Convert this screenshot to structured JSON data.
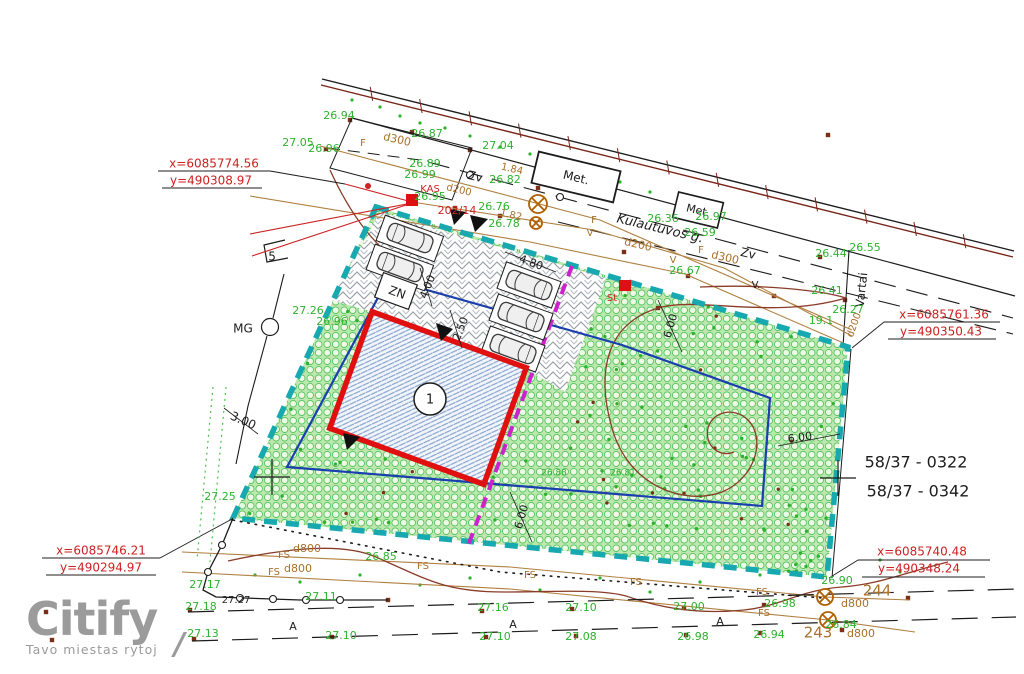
{
  "watermark": {
    "brand": "Citify",
    "tagline": "Tavo miestas rytoj",
    "mark": "/"
  },
  "colors": {
    "g": "#2db22d",
    "r": "#cc2222",
    "t": "#a8702a",
    "k": "#1c1c1c",
    "teal": "#18a8b0",
    "magenta": "#cc22cc",
    "blue": "#1a3fae",
    "building_red": "#e01010",
    "contour": "#8a3c28",
    "gray": "#9b9b9b"
  },
  "parcels": {
    "number_1": "58/37  -  0322",
    "number_2": "58/37  -  0342"
  },
  "street": {
    "name": "Kulautuvos g."
  },
  "building": {
    "number": "1"
  },
  "corner_coordinates": [
    {
      "pos": "top-left",
      "x": "x=6085774.56",
      "y": "y=490308.97"
    },
    {
      "pos": "right",
      "x": "x=6085761.36",
      "y": "y=490350.43"
    },
    {
      "pos": "bottom-left",
      "x": "x=6085746.21",
      "y": "y=490294.97"
    },
    {
      "pos": "bottom-right",
      "x": "x=6085740.48",
      "y": "y=490348.24"
    }
  ],
  "plan_labels": [
    {
      "n": "coord-top-left-x",
      "t": "x=6085774.56",
      "x": 214,
      "y": 164,
      "c": "r",
      "s": 12
    },
    {
      "n": "coord-top-left-y",
      "t": "y=490308.97",
      "x": 211,
      "y": 181,
      "c": "r",
      "s": 12
    },
    {
      "n": "coord-right-x",
      "t": "x=6085761.36",
      "x": 944,
      "y": 315,
      "c": "r",
      "s": 12
    },
    {
      "n": "coord-right-y",
      "t": "y=490350.43",
      "x": 941,
      "y": 332,
      "c": "r",
      "s": 12
    },
    {
      "n": "coord-bottom-left-x",
      "t": "x=6085746.21",
      "x": 101,
      "y": 551,
      "c": "r",
      "s": 12
    },
    {
      "n": "coord-bottom-left-y",
      "t": "y=490294.97",
      "x": 101,
      "y": 568,
      "c": "r",
      "s": 12
    },
    {
      "n": "coord-bottom-right-x",
      "t": "x=6085740.48",
      "x": 922,
      "y": 552,
      "c": "r",
      "s": 12
    },
    {
      "n": "coord-bottom-right-y",
      "t": "y=490348.24",
      "x": 919,
      "y": 569,
      "c": "r",
      "s": 12
    },
    {
      "n": "label-kas",
      "t": "KAS",
      "x": 430,
      "y": 189,
      "c": "r",
      "s": 10
    },
    {
      "n": "label-kas-number",
      "t": "202/14",
      "x": 457,
      "y": 211,
      "c": "r",
      "s": 11
    },
    {
      "n": "label-st",
      "t": "St",
      "x": 612,
      "y": 298,
      "c": "r",
      "s": 10
    },
    {
      "n": "parcel-number-1",
      "t": "58/37  -  0322",
      "x": 916,
      "y": 463,
      "s": 16
    },
    {
      "n": "parcel-number-2",
      "t": "58/37  -  0342",
      "x": 918,
      "y": 492,
      "s": 16
    },
    {
      "n": "street-name",
      "t": "Kulautuvos g.",
      "x": 660,
      "y": 229,
      "r": 13.5,
      "s": 13,
      "i": 1
    },
    {
      "n": "label-met-1",
      "t": "Met.",
      "x": 576,
      "y": 178,
      "r": 13.5,
      "s": 12
    },
    {
      "n": "label-met-2",
      "t": "Met.",
      "x": 698,
      "y": 211,
      "r": 13.5,
      "s": 11
    },
    {
      "n": "label-zv-1",
      "t": "Zv",
      "x": 475,
      "y": 177,
      "r": 13.5,
      "s": 12
    },
    {
      "n": "label-zv-2",
      "t": "Zv",
      "x": 748,
      "y": 254,
      "r": 13.5,
      "s": 12
    },
    {
      "n": "label-vartai",
      "t": "Vartai",
      "x": 862,
      "y": 290,
      "r": -84,
      "s": 12
    },
    {
      "n": "label-zn",
      "t": "ZN",
      "x": 397,
      "y": 293,
      "r": 20,
      "s": 12
    },
    {
      "n": "label-mg",
      "t": "MG",
      "x": 243,
      "y": 329,
      "s": 12
    },
    {
      "n": "label-5",
      "t": "5",
      "x": 272,
      "y": 257,
      "s": 12
    },
    {
      "n": "dim-3-00",
      "t": "3.00",
      "x": 243,
      "y": 421,
      "r": 24,
      "s": 12
    },
    {
      "n": "dim-4-80",
      "t": "4.80",
      "x": 531,
      "y": 263,
      "r": 20,
      "s": 11
    },
    {
      "n": "dim-2-50",
      "t": "2.50",
      "x": 461,
      "y": 329,
      "r": -68,
      "s": 11
    },
    {
      "n": "dim-4-00",
      "t": "4.00",
      "x": 428,
      "y": 287,
      "r": -68,
      "s": 11
    },
    {
      "n": "dim-6-00-a",
      "t": "6.00",
      "x": 671,
      "y": 326,
      "r": -74,
      "s": 11
    },
    {
      "n": "dim-6-00-b",
      "t": "6.00",
      "x": 522,
      "y": 517,
      "r": -74,
      "s": 11
    },
    {
      "n": "dim-6-00-c",
      "t": "6.00",
      "x": 800,
      "y": 438,
      "r": -8,
      "s": 11
    },
    {
      "n": "dim-1-84",
      "t": "1.84",
      "x": 512,
      "y": 169,
      "c": "t",
      "s": 10,
      "r": 13
    },
    {
      "n": "dim-1-82",
      "t": "1.82",
      "x": 511,
      "y": 215,
      "c": "t",
      "s": 10,
      "r": 13
    },
    {
      "n": "pipe-f-1",
      "t": "F",
      "x": 363,
      "y": 143,
      "c": "t",
      "s": 10
    },
    {
      "n": "pipe-d300-1",
      "t": "d300",
      "x": 397,
      "y": 140,
      "c": "t",
      "s": 11,
      "r": 13
    },
    {
      "n": "pipe-d200-1",
      "t": "d200",
      "x": 459,
      "y": 190,
      "c": "t",
      "s": 10,
      "r": 13
    },
    {
      "n": "pipe-f-2",
      "t": "F",
      "x": 594,
      "y": 220,
      "c": "t",
      "s": 10
    },
    {
      "n": "pipe-v-1",
      "t": "V",
      "x": 590,
      "y": 233,
      "c": "t",
      "s": 10
    },
    {
      "n": "pipe-d200-2",
      "t": "d200",
      "x": 638,
      "y": 245,
      "c": "t",
      "s": 11,
      "r": 13
    },
    {
      "n": "pipe-f-3",
      "t": "F",
      "x": 701,
      "y": 250,
      "c": "t",
      "s": 10
    },
    {
      "n": "pipe-d300-2",
      "t": "d300",
      "x": 725,
      "y": 258,
      "c": "t",
      "s": 11,
      "r": 13
    },
    {
      "n": "pipe-v-2",
      "t": "V",
      "x": 673,
      "y": 260,
      "c": "t",
      "s": 10
    },
    {
      "n": "pipe-v-3",
      "t": "V.",
      "x": 756,
      "y": 285,
      "c": "k",
      "s": 10
    },
    {
      "n": "pipe-d200-3",
      "t": "d200",
      "x": 854,
      "y": 325,
      "c": "t",
      "s": 10,
      "r": -70
    },
    {
      "n": "pipe-fs-1",
      "t": "FS",
      "x": 284,
      "y": 555,
      "c": "t",
      "s": 10
    },
    {
      "n": "pipe-d800-1",
      "t": "d800",
      "x": 307,
      "y": 549,
      "c": "t",
      "s": 11
    },
    {
      "n": "pipe-fs-2",
      "t": "FS",
      "x": 274,
      "y": 572,
      "c": "t",
      "s": 10
    },
    {
      "n": "pipe-d800-2",
      "t": "d800",
      "x": 298,
      "y": 569,
      "c": "t",
      "s": 11
    },
    {
      "n": "pipe-fs-3",
      "t": "FS",
      "x": 423,
      "y": 566,
      "c": "t",
      "s": 10
    },
    {
      "n": "pipe-fs-4",
      "t": "FS",
      "x": 530,
      "y": 575,
      "c": "t",
      "s": 10
    },
    {
      "n": "pipe-fs-5",
      "t": "FS",
      "x": 636,
      "y": 582,
      "c": "t",
      "s": 10
    },
    {
      "n": "pipe-fs-6",
      "t": "FS",
      "x": 762,
      "y": 592,
      "c": "t",
      "s": 10
    },
    {
      "n": "pipe-fs-7",
      "t": "FS",
      "x": 764,
      "y": 613,
      "c": "t",
      "s": 10
    },
    {
      "n": "pipe-d800-3",
      "t": "d800",
      "x": 855,
      "y": 604,
      "c": "t",
      "s": 11
    },
    {
      "n": "pipe-d800-4",
      "t": "d800",
      "x": 861,
      "y": 634,
      "c": "t",
      "s": 11
    },
    {
      "n": "manhole-244",
      "t": "244",
      "x": 877,
      "y": 591,
      "c": "t",
      "s": 15
    },
    {
      "n": "manhole-243",
      "t": "243",
      "x": 818,
      "y": 633,
      "c": "t",
      "s": 15
    },
    {
      "n": "elev-26-94-top",
      "t": "26.94",
      "x": 339,
      "y": 116,
      "c": "g"
    },
    {
      "n": "elev-27-05",
      "t": "27.05",
      "x": 298,
      "y": 143,
      "c": "g"
    },
    {
      "n": "elev-26-96-top",
      "t": "26.96",
      "x": 324,
      "y": 149,
      "c": "g"
    },
    {
      "n": "elev-26-87",
      "t": "26.87",
      "x": 427,
      "y": 134,
      "c": "g"
    },
    {
      "n": "elev-27-04",
      "t": "27.04",
      "x": 498,
      "y": 146,
      "c": "g"
    },
    {
      "n": "elev-26-89",
      "t": "26.89",
      "x": 425,
      "y": 164,
      "c": "g"
    },
    {
      "n": "elev-26-99",
      "t": "26.99",
      "x": 420,
      "y": 175,
      "c": "g"
    },
    {
      "n": "elev-26-95",
      "t": "26.95",
      "x": 430,
      "y": 197,
      "c": "g"
    },
    {
      "n": "elev-26-82",
      "t": "26.82",
      "x": 505,
      "y": 180,
      "c": "g"
    },
    {
      "n": "elev-26-76",
      "t": "26.76",
      "x": 494,
      "y": 207,
      "c": "g"
    },
    {
      "n": "elev-26-78",
      "t": "26.78",
      "x": 504,
      "y": 224,
      "c": "g"
    },
    {
      "n": "elev-26-36",
      "t": "26.36",
      "x": 663,
      "y": 219,
      "c": "g"
    },
    {
      "n": "elev-26-97",
      "t": "26.97",
      "x": 711,
      "y": 217,
      "c": "g"
    },
    {
      "n": "elev-26-59",
      "t": "26.59",
      "x": 700,
      "y": 233,
      "c": "g"
    },
    {
      "n": "elev-26-67",
      "t": "26.67",
      "x": 685,
      "y": 271,
      "c": "g"
    },
    {
      "n": "elev-26-55",
      "t": "26.55",
      "x": 865,
      "y": 248,
      "c": "g"
    },
    {
      "n": "elev-26-44",
      "t": "26.44",
      "x": 831,
      "y": 254,
      "c": "g"
    },
    {
      "n": "elev-26-41",
      "t": "26.41",
      "x": 827,
      "y": 291,
      "c": "g"
    },
    {
      "n": "elev-26-27",
      "t": "26.27",
      "x": 848,
      "y": 310,
      "c": "g"
    },
    {
      "n": "elev-19-1",
      "t": "19.1",
      "x": 821,
      "y": 321,
      "c": "g"
    },
    {
      "n": "elev-27-26",
      "t": "27.26",
      "x": 308,
      "y": 311,
      "c": "g"
    },
    {
      "n": "elev-26-96-mid",
      "t": "26.96",
      "x": 332,
      "y": 322,
      "c": "g"
    },
    {
      "n": "elev-27-25",
      "t": "27.25",
      "x": 220,
      "y": 497,
      "c": "g"
    },
    {
      "n": "elev-26-85",
      "t": "26.85",
      "x": 381,
      "y": 557,
      "c": "g"
    },
    {
      "n": "elev-27-17",
      "t": "27.17",
      "x": 205,
      "y": 585,
      "c": "g"
    },
    {
      "n": "elev-27-11",
      "t": "27.11",
      "x": 321,
      "y": 597,
      "c": "g"
    },
    {
      "n": "elev-27-18",
      "t": "27.18",
      "x": 201,
      "y": 607,
      "c": "g"
    },
    {
      "n": "elev-27-13",
      "t": "27.13",
      "x": 203,
      "y": 634,
      "c": "g"
    },
    {
      "n": "elev-27-10-b",
      "t": "27.10",
      "x": 341,
      "y": 636,
      "c": "g"
    },
    {
      "n": "elev-27-16",
      "t": "27.16",
      "x": 493,
      "y": 608,
      "c": "g"
    },
    {
      "n": "elev-27-10-c",
      "t": "27.10",
      "x": 495,
      "y": 637,
      "c": "g"
    },
    {
      "n": "elev-27-10-a",
      "t": "27.10",
      "x": 581,
      "y": 608,
      "c": "g"
    },
    {
      "n": "elev-27-08",
      "t": "27.08",
      "x": 581,
      "y": 637,
      "c": "g"
    },
    {
      "n": "elev-27-00",
      "t": "27.00",
      "x": 689,
      "y": 607,
      "c": "g"
    },
    {
      "n": "elev-26-98-b",
      "t": "26.98",
      "x": 693,
      "y": 637,
      "c": "g"
    },
    {
      "n": "elev-26-98-a",
      "t": "26.98",
      "x": 780,
      "y": 604,
      "c": "g"
    },
    {
      "n": "elev-26-94-b",
      "t": "26.94",
      "x": 769,
      "y": 635,
      "c": "g"
    },
    {
      "n": "elev-26-90",
      "t": "26.90",
      "x": 837,
      "y": 581,
      "c": "g"
    },
    {
      "n": "elev-26-84",
      "t": "26.84",
      "x": 841,
      "y": 625,
      "c": "g"
    },
    {
      "n": "elev-26-88",
      "t": "26.88",
      "x": 554,
      "y": 473,
      "c": "g",
      "s": 9
    },
    {
      "n": "elev-26-81",
      "t": "26.81",
      "x": 623,
      "y": 473,
      "c": "g",
      "s": 9
    },
    {
      "n": "note-27-27",
      "t": "27.27",
      "x": 236,
      "y": 600,
      "c": "k",
      "s": 10
    },
    {
      "n": "profile-a-1",
      "t": "A",
      "x": 293,
      "y": 627,
      "s": 11
    },
    {
      "n": "profile-a-2",
      "t": "A",
      "x": 513,
      "y": 625,
      "s": 11
    },
    {
      "n": "profile-a-3",
      "t": "A",
      "x": 720,
      "y": 622,
      "s": 11
    },
    {
      "n": "building-number",
      "t": "1",
      "x": 430,
      "y": 400,
      "s": 13
    }
  ]
}
